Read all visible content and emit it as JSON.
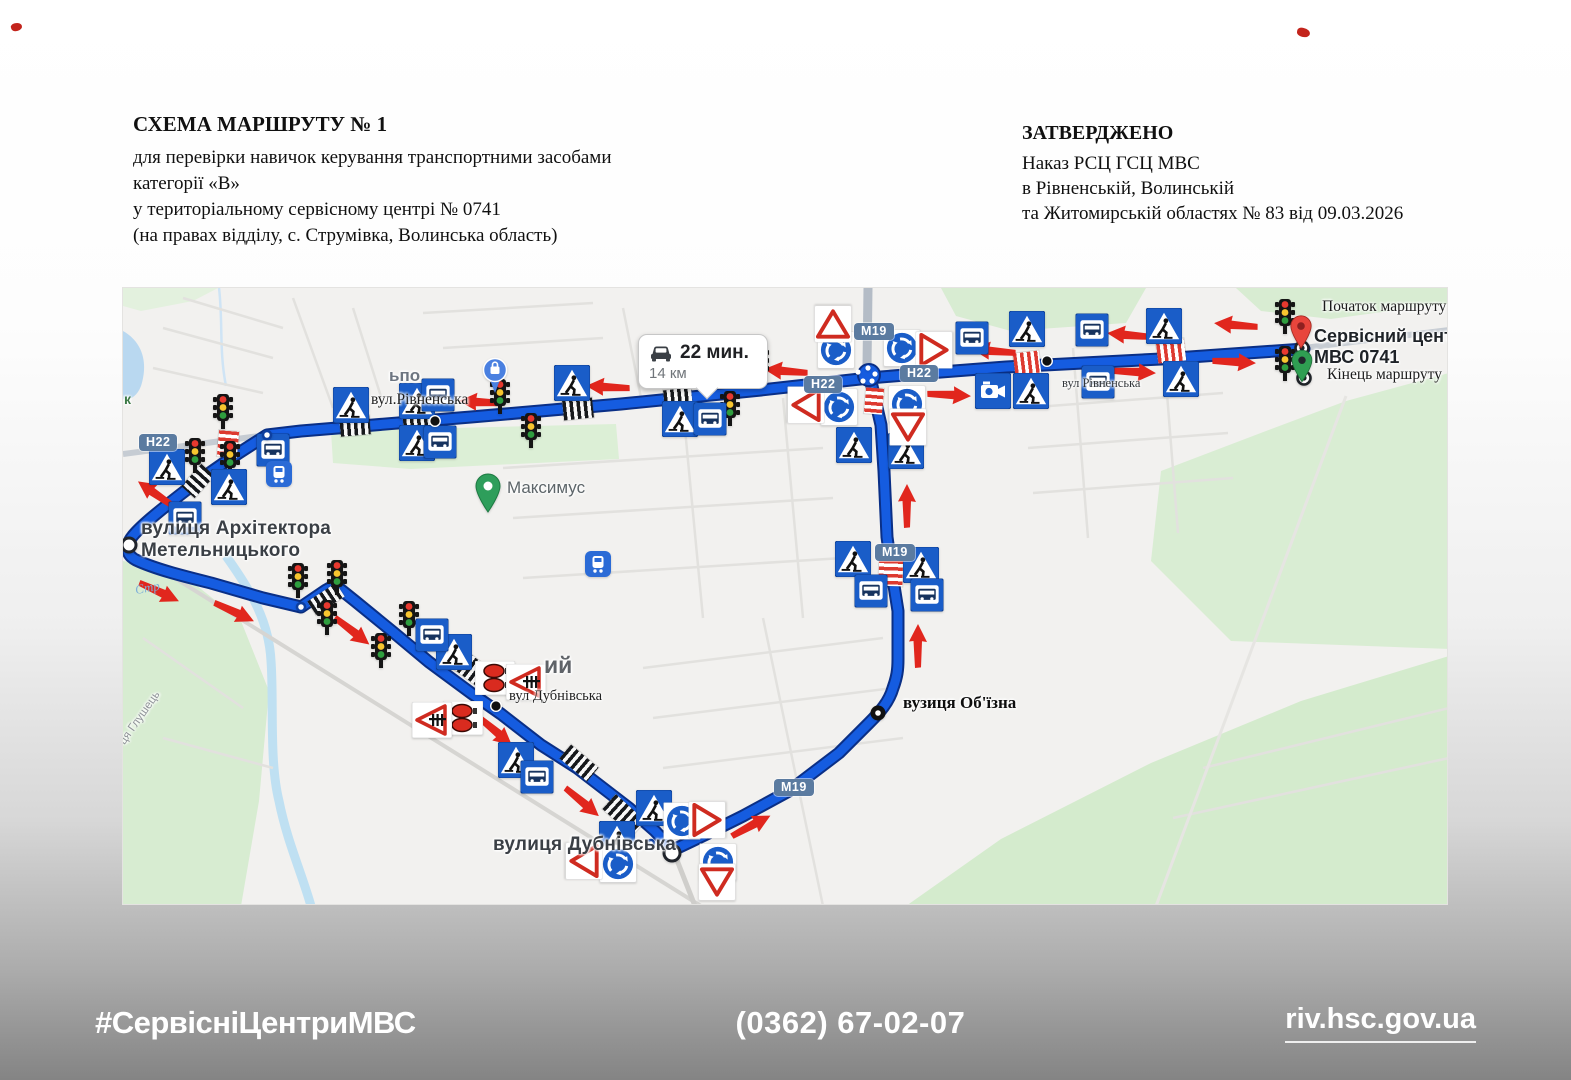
{
  "header_left": {
    "title": "СХЕМА МАРШРУТУ № 1",
    "lines": [
      "для перевірки навичок керування транспортними засобами",
      "категорії «В»",
      "у територіальному сервісному центрі № 0741",
      "(на правах відділу, с. Струмівка, Волинська область)"
    ]
  },
  "header_right": {
    "title": "ЗАТВЕРДЖЕНО",
    "lines": [
      "Наказ РСЦ ГСЦ МВС",
      "в Рівненській, Волинській",
      "та Житомирській областях № 83 від 09.03.2026"
    ]
  },
  "footer": {
    "hashtag": "#СервісніЦентриМВС",
    "phone": "(0362) 67-02-07",
    "website": "riv.hsc.gov.ua"
  },
  "map": {
    "tooltip": {
      "duration": "22 мин.",
      "distance": "14 км"
    },
    "colors": {
      "route": "#155ce0",
      "route_casing": "#0a2f86",
      "sign_blue": "#1a5dc8",
      "arrow_red": "#e1261d",
      "water": "#bfe0f2",
      "park": "#d8ecd2",
      "shield": "#5b7ba0"
    },
    "labels": [
      {
        "t": "вул.Рівненська",
        "x": 248,
        "y": 103,
        "c": "serif"
      },
      {
        "t": "вул Рівненська",
        "x": 939,
        "y": 88,
        "c": "serifsm"
      },
      {
        "t": "вулиця Архітектора",
        "x": 18,
        "y": 230,
        "c": "gbig"
      },
      {
        "t": "Метельницького",
        "x": 18,
        "y": 252,
        "c": "gbig"
      },
      {
        "t": "Максимус",
        "x": 384,
        "y": 190,
        "c": "gmed"
      },
      {
        "t": "ьпо",
        "x": 266,
        "y": 78,
        "c": "gmed2"
      },
      {
        "t": "ий",
        "x": 421,
        "y": 364,
        "c": "gbig2"
      },
      {
        "t": "вул Дубнівська",
        "x": 386,
        "y": 400,
        "c": "serifsm2"
      },
      {
        "t": "вулиця Дубнівська",
        "x": 370,
        "y": 546,
        "c": "gbig"
      },
      {
        "t": "вузиця Об'їзна",
        "x": 780,
        "y": 405,
        "c": "serifb"
      },
      {
        "t": "Початок маршруту",
        "x": 1199,
        "y": 10,
        "c": "serif"
      },
      {
        "t": "Сервісний центр",
        "x": 1191,
        "y": 38,
        "c": "gleg"
      },
      {
        "t": "МВС 0741",
        "x": 1191,
        "y": 59,
        "c": "gleg"
      },
      {
        "t": "Кінець маршруту",
        "x": 1204,
        "y": 78,
        "c": "serif"
      },
      {
        "t": "Стр",
        "x": 12,
        "y": 292,
        "c": "water",
        "r": -10
      },
      {
        "t": "ця Глушець",
        "x": -6,
        "y": 452,
        "c": "rotst",
        "r": -55
      },
      {
        "t": "к",
        "x": 1,
        "y": 103,
        "c": "parklbl"
      }
    ],
    "shields": [
      {
        "t": "Н22",
        "x": 16,
        "y": 146
      },
      {
        "t": "Н22",
        "x": 681,
        "y": 88
      },
      {
        "t": "Н22",
        "x": 777,
        "y": 77
      },
      {
        "t": "М19",
        "x": 731,
        "y": 35
      },
      {
        "t": "М19",
        "x": 752,
        "y": 256
      },
      {
        "t": "М19",
        "x": 651,
        "y": 491
      }
    ],
    "signs": [
      {
        "t": "tl",
        "x": 100,
        "y": 124
      },
      {
        "t": "tl",
        "x": 72,
        "y": 168
      },
      {
        "t": "tl",
        "x": 107,
        "y": 171
      },
      {
        "t": "tl",
        "x": 377,
        "y": 109
      },
      {
        "t": "tl",
        "x": 408,
        "y": 143
      },
      {
        "t": "tl",
        "x": 636,
        "y": 77
      },
      {
        "t": "tl",
        "x": 607,
        "y": 121
      },
      {
        "t": "tl",
        "x": 1162,
        "y": 29
      },
      {
        "t": "tl",
        "x": 1162,
        "y": 76
      },
      {
        "t": "tl",
        "x": 175,
        "y": 293
      },
      {
        "t": "tl",
        "x": 214,
        "y": 290
      },
      {
        "t": "tl",
        "x": 204,
        "y": 330
      },
      {
        "t": "tl",
        "x": 286,
        "y": 331
      },
      {
        "t": "tl",
        "x": 258,
        "y": 363
      },
      {
        "t": "ped",
        "x": 44,
        "y": 179
      },
      {
        "t": "ped",
        "x": 106,
        "y": 199
      },
      {
        "t": "ped",
        "x": 228,
        "y": 117
      },
      {
        "t": "ped",
        "x": 294,
        "y": 113
      },
      {
        "t": "ped",
        "x": 294,
        "y": 155
      },
      {
        "t": "ped",
        "x": 449,
        "y": 95
      },
      {
        "t": "ped",
        "x": 557,
        "y": 131
      },
      {
        "t": "ped",
        "x": 731,
        "y": 157
      },
      {
        "t": "ped",
        "x": 783,
        "y": 163
      },
      {
        "t": "ped",
        "x": 904,
        "y": 41
      },
      {
        "t": "ped",
        "x": 908,
        "y": 103
      },
      {
        "t": "ped",
        "x": 1041,
        "y": 38
      },
      {
        "t": "ped",
        "x": 1058,
        "y": 91
      },
      {
        "t": "ped",
        "x": 730,
        "y": 271
      },
      {
        "t": "ped",
        "x": 798,
        "y": 277
      },
      {
        "t": "ped",
        "x": 331,
        "y": 364
      },
      {
        "t": "ped",
        "x": 393,
        "y": 472
      },
      {
        "t": "ped",
        "x": 531,
        "y": 520
      },
      {
        "t": "ped",
        "x": 494,
        "y": 551
      },
      {
        "t": "bus",
        "x": 150,
        "y": 162
      },
      {
        "t": "bus",
        "x": 62,
        "y": 230
      },
      {
        "t": "bus",
        "x": 315,
        "y": 107
      },
      {
        "t": "bus",
        "x": 317,
        "y": 154
      },
      {
        "t": "bus",
        "x": 587,
        "y": 131
      },
      {
        "t": "bus",
        "x": 849,
        "y": 50
      },
      {
        "t": "bus",
        "x": 969,
        "y": 42
      },
      {
        "t": "bus",
        "x": 975,
        "y": 94
      },
      {
        "t": "bus",
        "x": 748,
        "y": 303
      },
      {
        "t": "bus",
        "x": 804,
        "y": 307
      },
      {
        "t": "bus",
        "x": 309,
        "y": 347
      },
      {
        "t": "bus",
        "x": 414,
        "y": 489
      },
      {
        "t": "rb",
        "x": 713,
        "y": 62
      },
      {
        "t": "rb",
        "x": 779,
        "y": 60
      },
      {
        "t": "rb",
        "x": 716,
        "y": 119
      },
      {
        "t": "rb",
        "x": 784,
        "y": 116
      },
      {
        "t": "rb",
        "x": 495,
        "y": 576
      },
      {
        "t": "rb",
        "x": 559,
        "y": 533
      },
      {
        "t": "rb",
        "x": 595,
        "y": 574
      },
      {
        "t": "yl",
        "x": 683,
        "y": 117,
        "r": 90
      },
      {
        "t": "yl",
        "x": 811,
        "y": 62,
        "r": -90
      },
      {
        "t": "yl",
        "x": 785,
        "y": 139,
        "r": 0
      },
      {
        "t": "yl",
        "x": 461,
        "y": 573,
        "r": 90
      },
      {
        "t": "yl",
        "x": 584,
        "y": 532,
        "r": -90
      },
      {
        "t": "yl",
        "x": 594,
        "y": 594,
        "r": 0
      },
      {
        "t": "yl",
        "x": 710,
        "y": 36,
        "r": 180
      },
      {
        "t": "rs",
        "x": 372,
        "y": 390
      },
      {
        "t": "rs",
        "x": 340,
        "y": 430
      },
      {
        "t": "rc",
        "x": 403,
        "y": 394
      },
      {
        "t": "rc",
        "x": 309,
        "y": 432
      },
      {
        "t": "cam",
        "x": 870,
        "y": 103
      },
      {
        "t": "tr",
        "x": 156,
        "y": 186
      },
      {
        "t": "tr",
        "x": 475,
        "y": 276
      },
      {
        "t": "pb",
        "x": 372,
        "y": 88
      },
      {
        "t": "pg",
        "x": 365,
        "y": 205
      },
      {
        "t": "nw",
        "x": 144,
        "y": 147,
        "d": 13
      },
      {
        "t": "nw",
        "x": 178,
        "y": 319,
        "d": 13
      },
      {
        "t": "nw",
        "x": 528,
        "y": 555,
        "d": 11
      },
      {
        "t": "nw",
        "x": 6,
        "y": 257,
        "d": 19
      },
      {
        "t": "nw",
        "x": 549,
        "y": 565,
        "d": 21
      },
      {
        "t": "nb",
        "x": 755,
        "y": 425
      },
      {
        "t": "dk",
        "x": 312,
        "y": 133
      },
      {
        "t": "dk",
        "x": 924,
        "y": 73
      },
      {
        "t": "dk",
        "x": 373,
        "y": 418
      },
      {
        "t": "jd",
        "x": 735,
        "y": 84
      },
      {
        "t": "jd",
        "x": 745,
        "y": 80
      },
      {
        "t": "jd",
        "x": 752,
        "y": 86
      },
      {
        "t": "jd",
        "x": 740,
        "y": 93
      },
      {
        "t": "jd",
        "x": 749,
        "y": 93
      },
      {
        "t": "be",
        "x": 1179,
        "y": 60
      },
      {
        "t": "pr",
        "x": 1178,
        "y": 44
      },
      {
        "t": "be",
        "x": 1181,
        "y": 90
      },
      {
        "t": "pe",
        "x": 1179,
        "y": 78
      }
    ],
    "arrows": [
      {
        "x": 358,
        "y": 114,
        "r": 183
      },
      {
        "x": 485,
        "y": 99,
        "r": 183
      },
      {
        "x": 663,
        "y": 83,
        "r": 185
      },
      {
        "x": 871,
        "y": 63,
        "r": 185
      },
      {
        "x": 1006,
        "y": 47,
        "r": 185
      },
      {
        "x": 1113,
        "y": 37,
        "r": 185
      },
      {
        "x": 826,
        "y": 107,
        "r": 3
      },
      {
        "x": 1011,
        "y": 84,
        "r": 3
      },
      {
        "x": 1111,
        "y": 74,
        "r": 3
      },
      {
        "x": 33,
        "y": 206,
        "r": 215
      },
      {
        "x": 36,
        "y": 304,
        "r": 25
      },
      {
        "x": 111,
        "y": 324,
        "r": 25
      },
      {
        "x": 229,
        "y": 343,
        "r": 38
      },
      {
        "x": 372,
        "y": 443,
        "r": 40
      },
      {
        "x": 459,
        "y": 514,
        "r": 40
      },
      {
        "x": 628,
        "y": 538,
        "r": -28
      },
      {
        "x": 795,
        "y": 358,
        "r": -90
      },
      {
        "x": 784,
        "y": 218,
        "r": -90
      }
    ],
    "crossings": [
      {
        "x": 232,
        "y": 138,
        "r": -5,
        "c": "bw",
        "l": 30,
        "w": 19
      },
      {
        "x": 294,
        "y": 132,
        "r": -5,
        "c": "bw",
        "l": 28,
        "w": 19
      },
      {
        "x": 455,
        "y": 121,
        "r": -6,
        "c": "bw",
        "l": 30,
        "w": 20
      },
      {
        "x": 555,
        "y": 111,
        "r": -6,
        "c": "bw",
        "l": 28,
        "w": 20
      },
      {
        "x": 904,
        "y": 75,
        "r": -7,
        "c": "rw",
        "l": 26,
        "w": 22
      },
      {
        "x": 1048,
        "y": 63,
        "r": -7,
        "c": "rw",
        "l": 28,
        "w": 22
      },
      {
        "x": 105,
        "y": 156,
        "r": 95,
        "c": "rw",
        "l": 26,
        "w": 20
      },
      {
        "x": 75,
        "y": 193,
        "r": 132,
        "c": "bw",
        "l": 30,
        "w": 18
      },
      {
        "x": 751,
        "y": 113,
        "r": 95,
        "c": "rw",
        "l": 26,
        "w": 18
      },
      {
        "x": 768,
        "y": 278,
        "r": 92,
        "c": "rw",
        "l": 40,
        "w": 24
      },
      {
        "x": 203,
        "y": 311,
        "r": -33,
        "c": "bw",
        "l": 34,
        "w": 16
      },
      {
        "x": 345,
        "y": 378,
        "r": 37,
        "c": "bw",
        "l": 40,
        "w": 22
      },
      {
        "x": 456,
        "y": 475,
        "r": 40,
        "c": "bw",
        "l": 36,
        "w": 18
      },
      {
        "x": 501,
        "y": 527,
        "r": 42,
        "c": "bw",
        "l": 40,
        "w": 20
      }
    ]
  }
}
